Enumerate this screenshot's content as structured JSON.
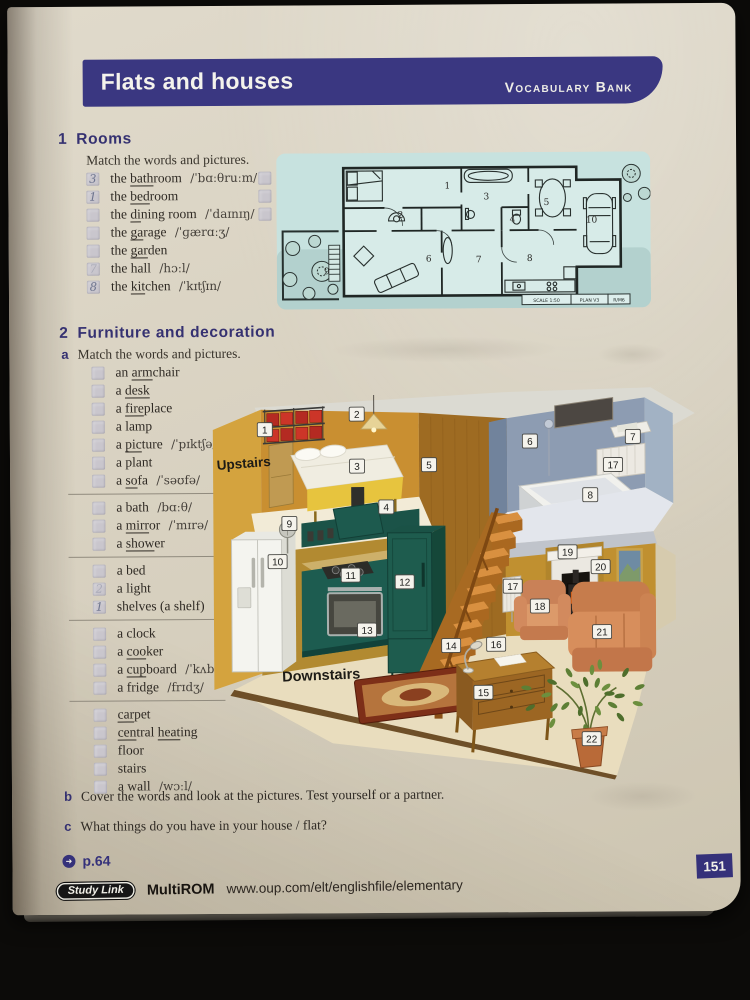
{
  "page": {
    "number": "151"
  },
  "header": {
    "title": "Flats and houses",
    "banner_right": "Vocabulary Bank",
    "banner_color": "#3a3781"
  },
  "section1": {
    "number": "1",
    "title": "Rooms",
    "instruction": "Match the words and pictures.",
    "col1": [
      {
        "answer": "3",
        "p": [
          {
            "t": "the "
          },
          {
            "t": "bath",
            "u": true
          },
          {
            "t": "room "
          }
        ],
        "ipa": "/ˈbɑːθruːm/"
      },
      {
        "answer": "1",
        "p": [
          {
            "t": "the "
          },
          {
            "t": "bed",
            "u": true
          },
          {
            "t": "room"
          }
        ]
      },
      {
        "answer": "",
        "p": [
          {
            "t": "the "
          },
          {
            "t": "di",
            "u": true
          },
          {
            "t": "ning room "
          }
        ],
        "ipa": "/ˈdaɪnɪŋ/"
      },
      {
        "answer": "",
        "p": [
          {
            "t": "the "
          },
          {
            "t": "ga",
            "u": true
          },
          {
            "t": "rage "
          }
        ],
        "ipa": "/ˈɡærɑːʒ/"
      },
      {
        "answer": "",
        "p": [
          {
            "t": "the "
          },
          {
            "t": "gar",
            "u": true
          },
          {
            "t": "den"
          }
        ]
      },
      {
        "answer": "7",
        "faint": true,
        "p": [
          {
            "t": "the hall "
          }
        ],
        "ipa": "/hɔːl/"
      },
      {
        "answer": "8",
        "p": [
          {
            "t": "the "
          },
          {
            "t": "kit",
            "u": true
          },
          {
            "t": "chen "
          }
        ],
        "ipa": "/ˈkɪtʃɪn/"
      }
    ],
    "col2": [
      {
        "answer": "",
        "p": [
          {
            "t": "the "
          },
          {
            "t": "liv",
            "u": true
          },
          {
            "t": "ing room"
          }
        ]
      },
      {
        "answer": "",
        "p": [
          {
            "t": "the "
          },
          {
            "t": "stu",
            "u": true
          },
          {
            "t": "dy"
          }
        ]
      },
      {
        "answer": "",
        "p": [
          {
            "t": "the "
          },
          {
            "t": "toi",
            "u": true
          },
          {
            "t": "let"
          }
        ]
      }
    ]
  },
  "floor_plan": {
    "room_numbers": [
      "1",
      "2",
      "3",
      "4",
      "5",
      "6",
      "7",
      "8",
      "9",
      "10"
    ],
    "caption": [
      "SCALE 1:50",
      "PLAN V3",
      "R/M6"
    ]
  },
  "section2": {
    "number": "2",
    "title": "Furniture and decoration",
    "a_label": "a",
    "a_instruction": "Match the words and pictures.",
    "groups": [
      [
        {
          "answer": "",
          "p": [
            {
              "t": "an "
            },
            {
              "t": "arm",
              "u": true
            },
            {
              "t": "chair"
            }
          ]
        },
        {
          "answer": "",
          "p": [
            {
              "t": "a "
            },
            {
              "t": "desk",
              "u": true
            }
          ]
        },
        {
          "answer": "",
          "p": [
            {
              "t": "a "
            },
            {
              "t": "fire",
              "u": true
            },
            {
              "t": "place"
            }
          ]
        },
        {
          "answer": "",
          "p": [
            {
              "t": "a lamp"
            }
          ]
        },
        {
          "answer": "",
          "p": [
            {
              "t": "a "
            },
            {
              "t": "pic",
              "u": true
            },
            {
              "t": "ture "
            }
          ],
          "ipa": "/ˈpɪktʃə/"
        },
        {
          "answer": "",
          "p": [
            {
              "t": "a plant"
            }
          ]
        },
        {
          "answer": "",
          "p": [
            {
              "t": "a "
            },
            {
              "t": "so",
              "u": true
            },
            {
              "t": "fa "
            }
          ],
          "ipa": "/ˈsəʊfə/"
        }
      ],
      [
        {
          "answer": "",
          "p": [
            {
              "t": "a bath "
            }
          ],
          "ipa": "/bɑːθ/"
        },
        {
          "answer": "",
          "p": [
            {
              "t": "a "
            },
            {
              "t": "mirr",
              "u": true
            },
            {
              "t": "or "
            }
          ],
          "ipa": "/ˈmɪrə/"
        },
        {
          "answer": "",
          "p": [
            {
              "t": "a "
            },
            {
              "t": "show",
              "u": true
            },
            {
              "t": "er"
            }
          ]
        }
      ],
      [
        {
          "answer": "",
          "p": [
            {
              "t": "a bed"
            }
          ]
        },
        {
          "answer": "2",
          "faint": true,
          "p": [
            {
              "t": "a light"
            }
          ]
        },
        {
          "answer": "1",
          "p": [
            {
              "t": "shelves (a shelf)"
            }
          ]
        }
      ],
      [
        {
          "answer": "",
          "p": [
            {
              "t": "a clock"
            }
          ]
        },
        {
          "answer": "",
          "p": [
            {
              "t": "a "
            },
            {
              "t": "coo",
              "u": true
            },
            {
              "t": "ker"
            }
          ]
        },
        {
          "answer": "",
          "p": [
            {
              "t": "a "
            },
            {
              "t": "cup",
              "u": true
            },
            {
              "t": "board "
            }
          ],
          "ipa": "/ˈkʌbəd/"
        },
        {
          "answer": "",
          "p": [
            {
              "t": "a fridge "
            }
          ],
          "ipa": "/frɪdʒ/"
        }
      ],
      [
        {
          "answer": "",
          "p": [
            {
              "t": "car",
              "u": true
            },
            {
              "t": "pet"
            }
          ]
        },
        {
          "answer": "",
          "p": [
            {
              "t": "cen",
              "u": true
            },
            {
              "t": "tral "
            },
            {
              "t": "heat",
              "u": true
            },
            {
              "t": "ing"
            }
          ]
        },
        {
          "answer": "",
          "p": [
            {
              "t": "floor"
            }
          ]
        },
        {
          "answer": "",
          "p": [
            {
              "t": "stairs"
            }
          ]
        },
        {
          "answer": "",
          "p": [
            {
              "t": "a wall "
            }
          ],
          "ipa": "/wɔːl/"
        }
      ]
    ]
  },
  "house": {
    "labels": {
      "upstairs": "Upstairs",
      "downstairs": "Downstairs"
    },
    "tags": [
      "1",
      "2",
      "3",
      "4",
      "5",
      "6",
      "7",
      "17",
      "8",
      "9",
      "10",
      "11",
      "12",
      "13",
      "14",
      "15",
      "16",
      "17",
      "18",
      "19",
      "20",
      "21",
      "22"
    ]
  },
  "item_b": {
    "label": "b",
    "text": "Cover the words and look at the pictures. Test yourself or a partner."
  },
  "item_c": {
    "label": "c",
    "text": "What things do you have in your house / flat?"
  },
  "footer": {
    "page_link": "p.64",
    "studylink": "Study Link",
    "multirom": "MultiROM",
    "url": "www.oup.com/elt/englishfile/elementary"
  }
}
